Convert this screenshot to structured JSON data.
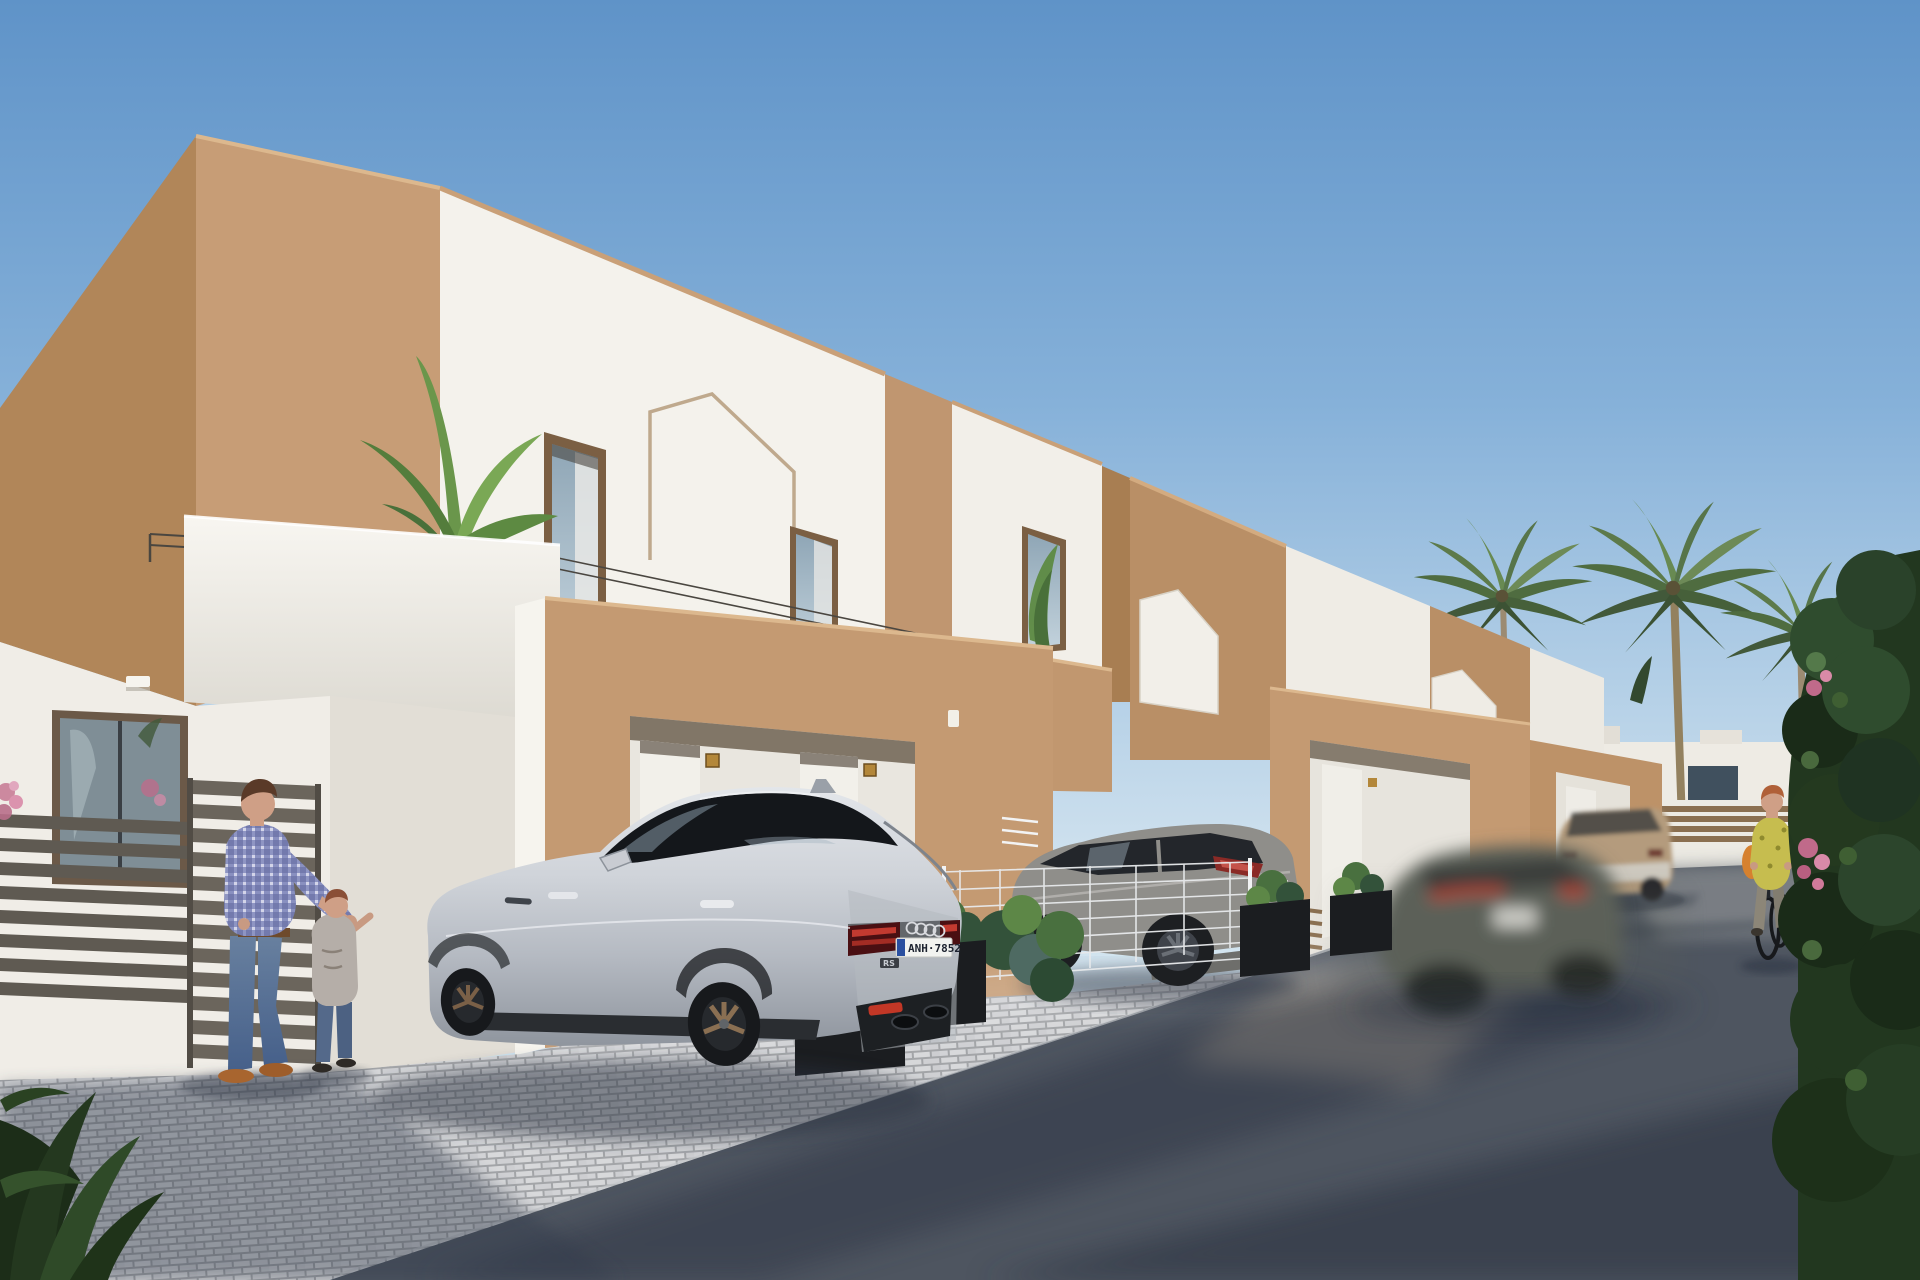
{
  "scene": {
    "kind": "3d-architectural-render",
    "subject": "street of new-build modern villas with parked cars, palm trees and pedestrians",
    "lighting": "sunny, light from the right, long shadows across the road"
  },
  "vehicles": {
    "audi": {
      "body_color_name": "silver",
      "plate_text": "ANH·7852",
      "badge_text": "RS"
    },
    "grey_suv": {
      "body_color_name": "grey",
      "position": "parked behind white mesh fence"
    },
    "moving_car": {
      "body_color_name": "dark grey",
      "motion": "blurred, driving on road"
    },
    "beige_suv": {
      "body_color_name": "beige",
      "position": "parked far right"
    }
  },
  "people": {
    "man_with_child": {
      "man": "plaid shirt, jeans, brown shoes",
      "child": "grey tee, jeans"
    },
    "cyclist": {
      "look": "yellow patterned top, orange bag, grey trousers, dark bicycle"
    }
  },
  "landscape": {
    "palm_count": 3,
    "hedge": "dark green with pink bougainvillea",
    "paving": "light cobblestone apron, dark asphalt road"
  },
  "palette": {
    "sky_top": "#5f93c8",
    "sky_horizon": "#d5e5f0",
    "tan_sunlit": "#c79d76",
    "tan_shaded": "#b18659",
    "tan_porch": "#c49a72",
    "white_sunlit": "#f5f3ee",
    "white_shaded": "#e8e5de",
    "window_frame": "#7b5f43",
    "glass": "#a9b9c4",
    "cobble_light": "#d6d7d9",
    "cobble_joint": "#a3a5a8",
    "road": "#4e5560",
    "road_shadow": "#2e3644",
    "road_sunlit": "#a69d8e",
    "hedge_dark": "#22371f",
    "hedge_mid": "#2f4c2e",
    "palm_green": "#5d7a4a",
    "palm_trunk": "#9c8b72",
    "audi_silver": "#c9ccd2",
    "taillight_red": "#c23a30",
    "plate_blue": "#2a4fa0",
    "grey_suv": "#8f8e8a",
    "beige_car": "#b49b7d",
    "moving_car": "#5c6058",
    "planter": "#1b1d20",
    "gold_plaque": "#b3873a",
    "shirt_plaid": "#737aad",
    "jeans": "#5f7898",
    "shoes_brown": "#a8652f",
    "cyclist_top": "#c6bd4f",
    "cyclist_bag": "#d6812f",
    "skin": "#cf9f86"
  }
}
